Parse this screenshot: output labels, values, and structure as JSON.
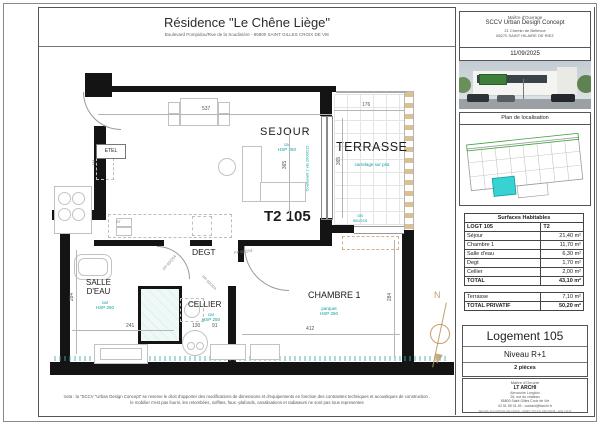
{
  "title_block": {
    "title": "Résidence \"Le Chêne Liège\"",
    "subtitle": "Boulevard Pompidou/Rue de la Soudinière - 85800 SAINT GILLES CROIX DE VIE"
  },
  "sidebar": {
    "owner_role": "Maître d'Ouvrage",
    "owner_name": "SCCV Urban Design Concept",
    "owner_address1": "21 Chemin de Bellevue",
    "owner_address2": "85270 SAINT HILAIRE DE RIEZ",
    "date": "11/09/2025",
    "location_plan_label": "Plan de localisation",
    "table": {
      "title": "Surfaces Habitables",
      "logt": "LOGT 105",
      "type": "T2",
      "rows": [
        [
          "Séjour",
          "21,40 m²"
        ],
        [
          "Chambre 1",
          "11,70 m²"
        ],
        [
          "Salle d'eau",
          "6,30 m²"
        ],
        [
          "Degt",
          "1,70 m²"
        ],
        [
          "Cellier",
          "2,00 m²"
        ]
      ],
      "total_label": "TOTAL",
      "total_value": "43,10 m²",
      "terrasse_label": "Terrasse",
      "terrasse_value": "7,10 m²",
      "privatif_label": "TOTAL PRIVATIF",
      "privatif_value": "50,20 m²"
    },
    "unit_title": "Logement 105",
    "unit_level": "Niveau R+1",
    "unit_rooms": "2 pièces",
    "moe_role": "Maître d'Oeuvre",
    "moe_name": "LT ARCHI",
    "moe_person": "Alexandre Langlois",
    "moe_address": "26, rue du château\n85800 Saint Gilles Croix de Vie\n02 51 55 01 49 - contact@ltarchi.fr",
    "moe_legal": "SELARL AU CAPITAL DE 1000 € - SIRET 479 047 936 00038 - APE 7111Z"
  },
  "plan": {
    "unit_label": "T2 105",
    "labels": {
      "sejour": "SEJOUR",
      "terrasse": "TERRASSE",
      "chambre": "CHAMBRE 1",
      "salle_deau": "SALLE\nD'EAU",
      "degt": "DEGT",
      "cellier": "CELLIER",
      "etel": "ETEL",
      "fr": "FR",
      "at": "AT",
      "north": "N"
    },
    "ann": {
      "sejour": "car\nHSP 250",
      "terrasse": "carrelage sur plot",
      "chambre": "parquet\nHSP 250",
      "salle_deau": "car\nHSP 250",
      "cellier": "car\nHSP 250",
      "coulissant": "Coulissant 2 vtx 2600/215",
      "ob": "OB\n900/215",
      "door_chambre": "PP 83/204",
      "door_sdb": "PP 63/204",
      "door_cellier": "PP 63/204"
    },
    "dims": {
      "sejour_w": "537",
      "terrasse_w": "176",
      "sejour_h": "365",
      "terrasse_h": "365",
      "sdb_w": "241",
      "cellier_w": "130",
      "cellier_w2": "91",
      "chambre_w": "412",
      "chambre_h": "284",
      "sdb_h": "284"
    }
  },
  "nota_line1": "nota : la \"SCCV \"Urban Design Concept\" se reserve le droit d'apporter des modifications de dimensions et d'equipements en fonction des contraintes techniques et acoustiques de construction .",
  "nota_line2": "le mobilier n'est pas fourni, les retombées, soffites, faux -plafonds, canalisations et radiateurs ne sont pas tous representes"
}
